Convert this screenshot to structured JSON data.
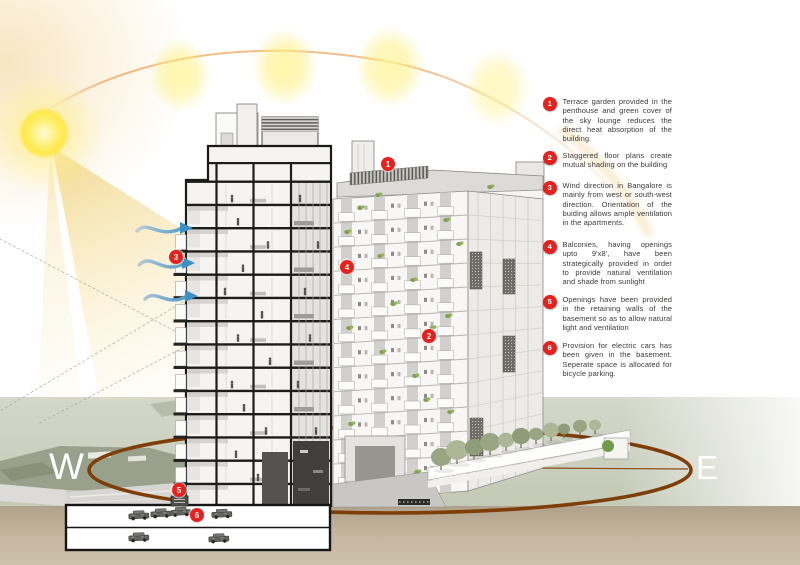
{
  "compass": {
    "west": "W",
    "east": "E"
  },
  "markers": [
    {
      "number": "1"
    },
    {
      "number": "2"
    },
    {
      "number": "3"
    },
    {
      "number": "4"
    },
    {
      "number": "5"
    },
    {
      "number": "6"
    }
  ],
  "annotations": [
    {
      "number": "1",
      "text": "Terrace garden provided in the penthouse and green cover of the sky lounge reduces the direct heat absorption of the building."
    },
    {
      "number": "2",
      "text": "Staggered floor plans create mutual shading on the building"
    },
    {
      "number": "3",
      "text": "Wind direction in Bangalore is mainly from west or south-west direction. Orientation of the buiding allows ample ventilation in the apartments."
    },
    {
      "number": "4",
      "text": "Balconies, having openings upto 9'x8', have been strategically provided in order to provide natural ventilation and shade from sunlight"
    },
    {
      "number": "5",
      "text": "Openings have been provided in the retaining walls of the basement so as to allow natural light and ventilation"
    },
    {
      "number": "6",
      "text": "Provision for electric cars has been given in the basement. Seperate space is allocated for bicycle parking."
    }
  ],
  "icons": [
    {
      "name": "sun-icon"
    },
    {
      "name": "sun-path-arc"
    },
    {
      "name": "wind-arrow-icon"
    },
    {
      "name": "orbit-ellipse"
    }
  ],
  "colors": {
    "marker_red": "#e6211e",
    "sun_yellow": "#ffe94d",
    "wind_blue": "#4293c5",
    "orbit_brown": "#7d3e08",
    "arc_orange": "#f0b077",
    "ground_green": "#cdd1c3",
    "ground_tan": "#c0b09a"
  }
}
